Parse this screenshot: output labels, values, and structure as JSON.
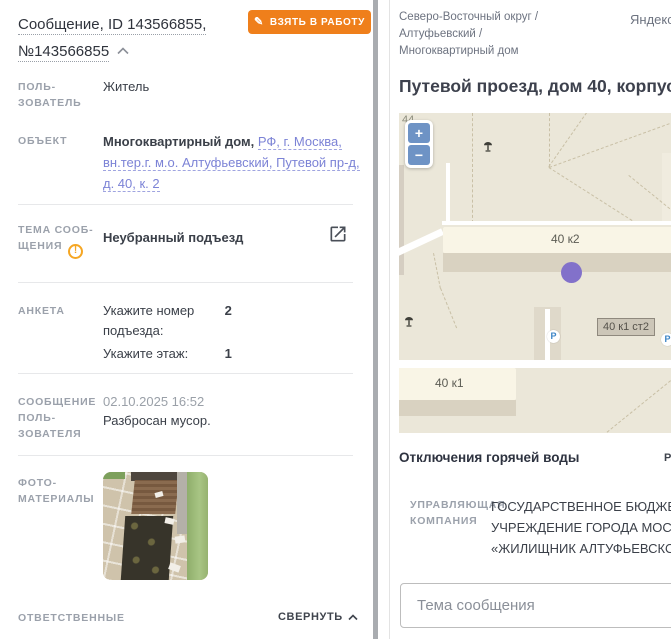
{
  "left_panel": {
    "title": {
      "line1": "Сообщение, ID 143566855,",
      "line2": "№143566855"
    },
    "take_to_work_button": "ВЗЯТЬ В РАБОТУ",
    "user": {
      "label": "ПОЛЬ-ЗОВАТЕЛЬ",
      "value": "Житель"
    },
    "object": {
      "label": "ОБЪЕКТ",
      "value_bold": "Многоквартирный дом,",
      "value_link": "РФ, г. Москва, вн.тер.г. м.о. Алтуфьевский, Путевой пр-д, д. 40, к. 2"
    },
    "theme": {
      "label": "ТЕМА СООБ-ЩЕНИЯ",
      "warning": "!",
      "value": "Неубранный подъезд"
    },
    "anketa": {
      "label": "АНКЕТА",
      "rows": [
        {
          "question": "Укажите номер подъезда:",
          "answer": "2"
        },
        {
          "question": "Укажите этаж:",
          "answer": "1"
        }
      ]
    },
    "user_message": {
      "label": "СООБЩЕНИЕ ПОЛЬ-ЗОВАТЕЛЯ",
      "date": "02.10.2025 16:52",
      "text": "Разбросан мусор."
    },
    "photo": {
      "label": "ФОТО-МАТЕРИАЛЫ"
    },
    "responsible": {
      "label": "ОТВЕТСТВЕННЫЕ",
      "collapse_link": "СВЕРНУТЬ"
    }
  },
  "right_panel": {
    "breadcrumb": {
      "line1": "Северо-Восточный округ /",
      "line2": "Алтуфьевский /",
      "line3": "Многоквартирный дом"
    },
    "map_provider": "Яндекс",
    "address_title": "Путевой проезд, дом 40, корпус 2",
    "map": {
      "zoom_in": "+",
      "zoom_out": "−",
      "partial_house_number": "44",
      "label_40k2": "40 к2",
      "label_40k1st2": "40 к1 ст2",
      "label_40k1": "40 к1",
      "parking_label": "P"
    },
    "hot_water": {
      "title": "Отключения горячей воды",
      "expand_partial": "Р"
    },
    "management_company": {
      "label": "УПРАВЛЯЮЩАЯ КОМПАНИЯ",
      "line1": "ГОСУДАРСТВЕННОЕ БЮДЖЕТНОЕ",
      "line2": "УЧРЕЖДЕНИЕ ГОРОДА МОСКВЫ",
      "line3": "«ЖИЛИЩНИК АЛТУФЬЕВСКОГО РА"
    },
    "topic_input": {
      "placeholder": "Тема сообщения"
    }
  },
  "colors": {
    "accent_orange": "#ef7f1b",
    "link_purple": "#7c83d6",
    "marker_purple": "#8271ca",
    "map_background": "#ebe7d9"
  }
}
